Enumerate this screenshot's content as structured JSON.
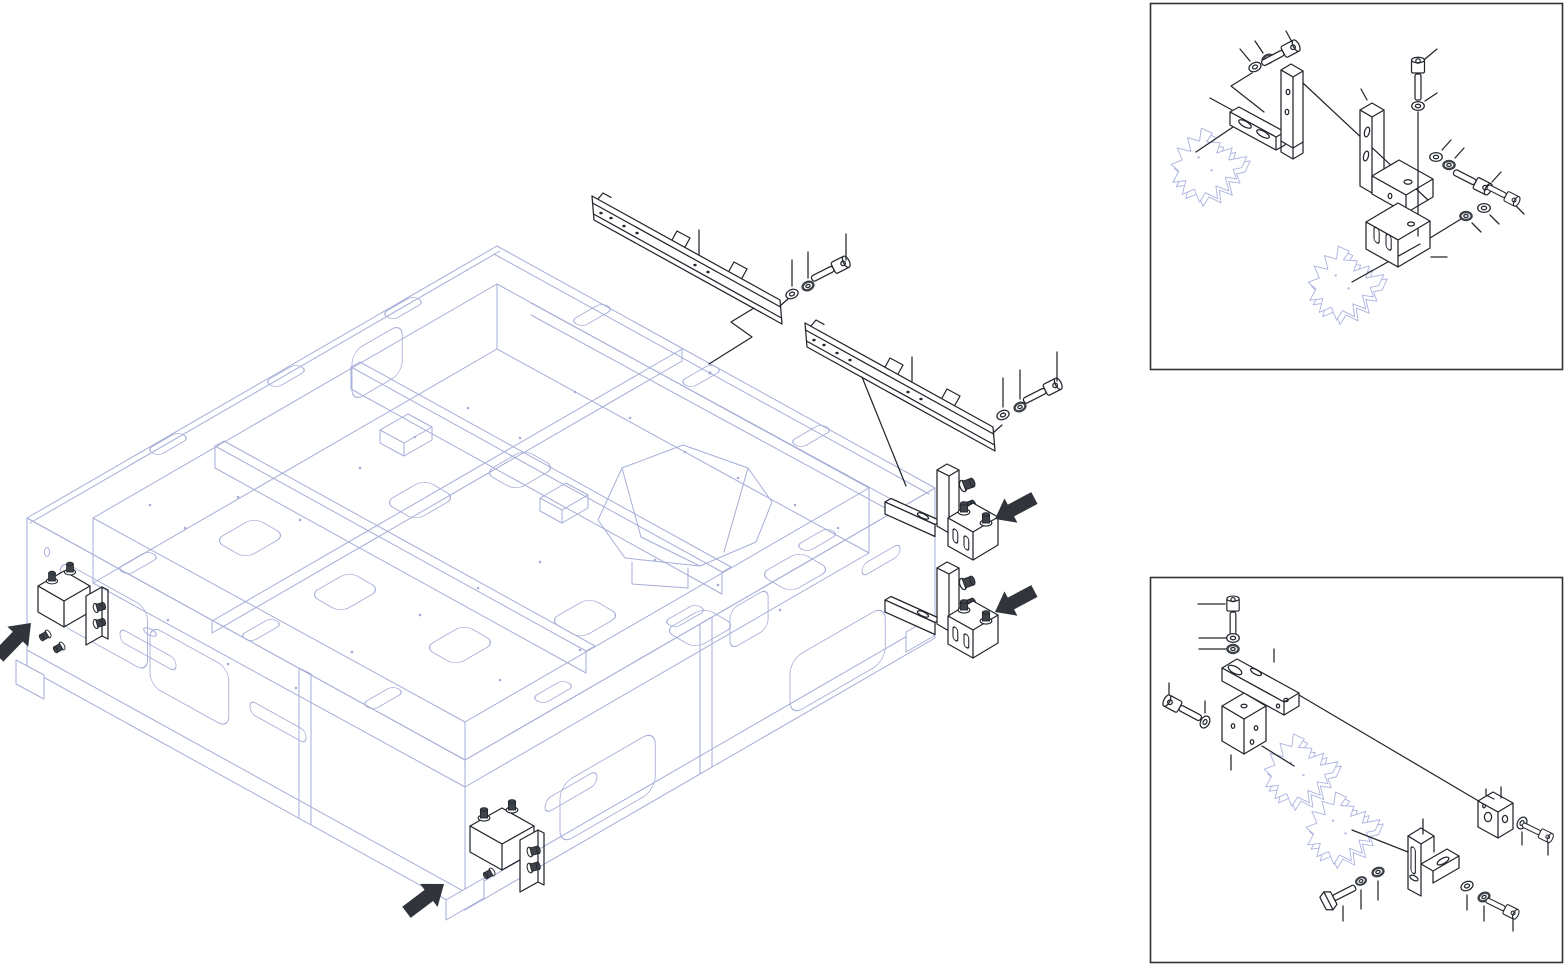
{
  "document": {
    "type": "exploded-assembly-diagram",
    "description_of_pixels": "isometric wireframe machine base with exploded black hardware, four solid direction arrows, two detail boxes",
    "visible_text": "",
    "background": "#ffffff"
  },
  "colors": {
    "background": "#ffffff",
    "frame-line": "#a6aed8",
    "ghost-line": "#aeb5e0",
    "part-line": "#22262c",
    "dark-fill": "#3e434a",
    "arrow-fill": "#31353b",
    "box-border": "#2e3238"
  },
  "main_view": {
    "machine_frame": {
      "style": "isometric-wireframe",
      "color_ref": "frame-line"
    },
    "exploded_parts": [
      {
        "name": "mounting-rail-upper",
        "fasteners": [
          "washer",
          "flange-nut",
          "socket-head-screw"
        ]
      },
      {
        "name": "mounting-rail-lower",
        "fasteners": [
          "washer",
          "flange-nut",
          "socket-head-screw"
        ]
      },
      {
        "name": "clamp-bracket-right-upper",
        "screw_count": 4
      },
      {
        "name": "clamp-bracket-right-lower",
        "screw_count": 4
      },
      {
        "name": "clamp-bracket-left-corner",
        "screw_count": 5
      },
      {
        "name": "clamp-bracket-front-bottom",
        "screw_count": 5
      }
    ],
    "direction_arrow_count": 4
  },
  "detail_views": [
    {
      "name": "detail-view-top-right",
      "position": "top-right",
      "parts": [
        "slotted-spacer-block",
        "angle-bracket",
        "angle-bracket-with-foot",
        "notched-clamp-block",
        "ghost-star-plate",
        "ghost-star-plate"
      ],
      "fastener_counts": {
        "socket_head_screws": 4,
        "washers": 4,
        "flange_nuts": 4
      }
    },
    {
      "name": "detail-view-bottom-right",
      "position": "bottom-right",
      "parts": [
        "cover-plate",
        "clamp-cube-block",
        "pivot-block",
        "slotted-angle-bracket",
        "ghost-star-plate",
        "ghost-star-plate"
      ],
      "fastener_counts": {
        "socket_head_screws": 4,
        "hex_bolts": 1,
        "washers": 5,
        "flange_nuts": 4
      }
    }
  ]
}
